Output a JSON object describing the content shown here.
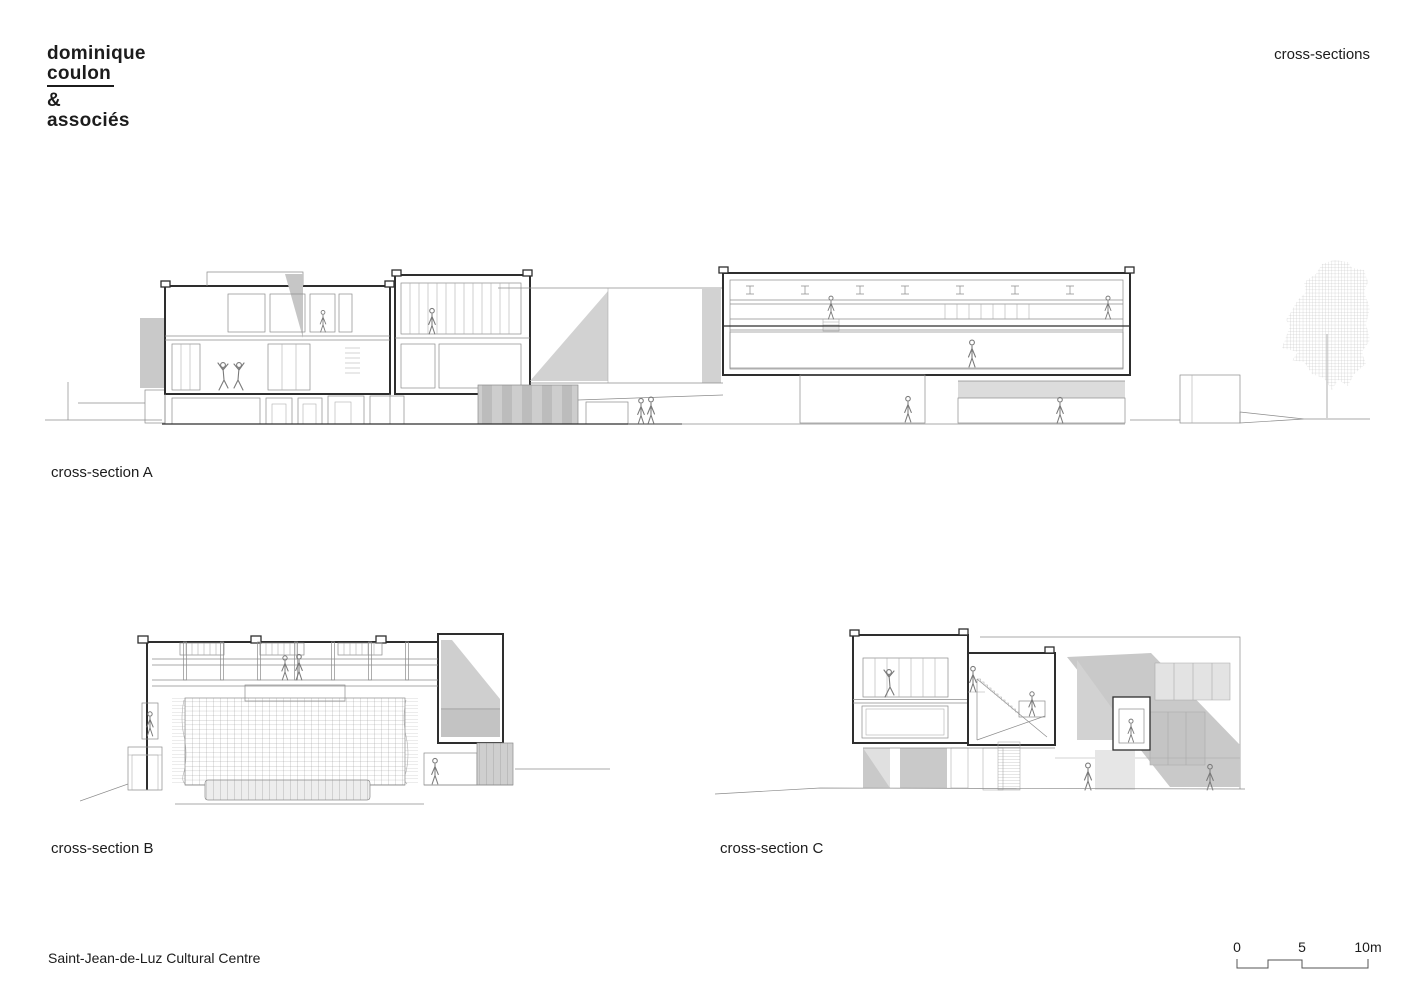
{
  "logo": {
    "line1": "dominique",
    "line2": "coulon",
    "line3": "&",
    "line4": "associés"
  },
  "header": {
    "title": "cross-sections"
  },
  "sections": [
    {
      "id": "A",
      "label": "cross-section A"
    },
    {
      "id": "B",
      "label": "cross-section B"
    },
    {
      "id": "C",
      "label": "cross-section C"
    }
  ],
  "footer": {
    "project_title": "Saint-Jean-de-Luz Cultural Centre"
  },
  "scale_bar": {
    "ticks": [
      "0",
      "5",
      "10m"
    ]
  },
  "colors": {
    "ink": "#1c1c1c",
    "cut_line": "#2e2e2e",
    "thin_line": "#8c8c8c",
    "shadow_light": "#d2d2d2",
    "shadow_mid": "#c9c9c9",
    "stripe_dark": "#bcbcbc"
  }
}
